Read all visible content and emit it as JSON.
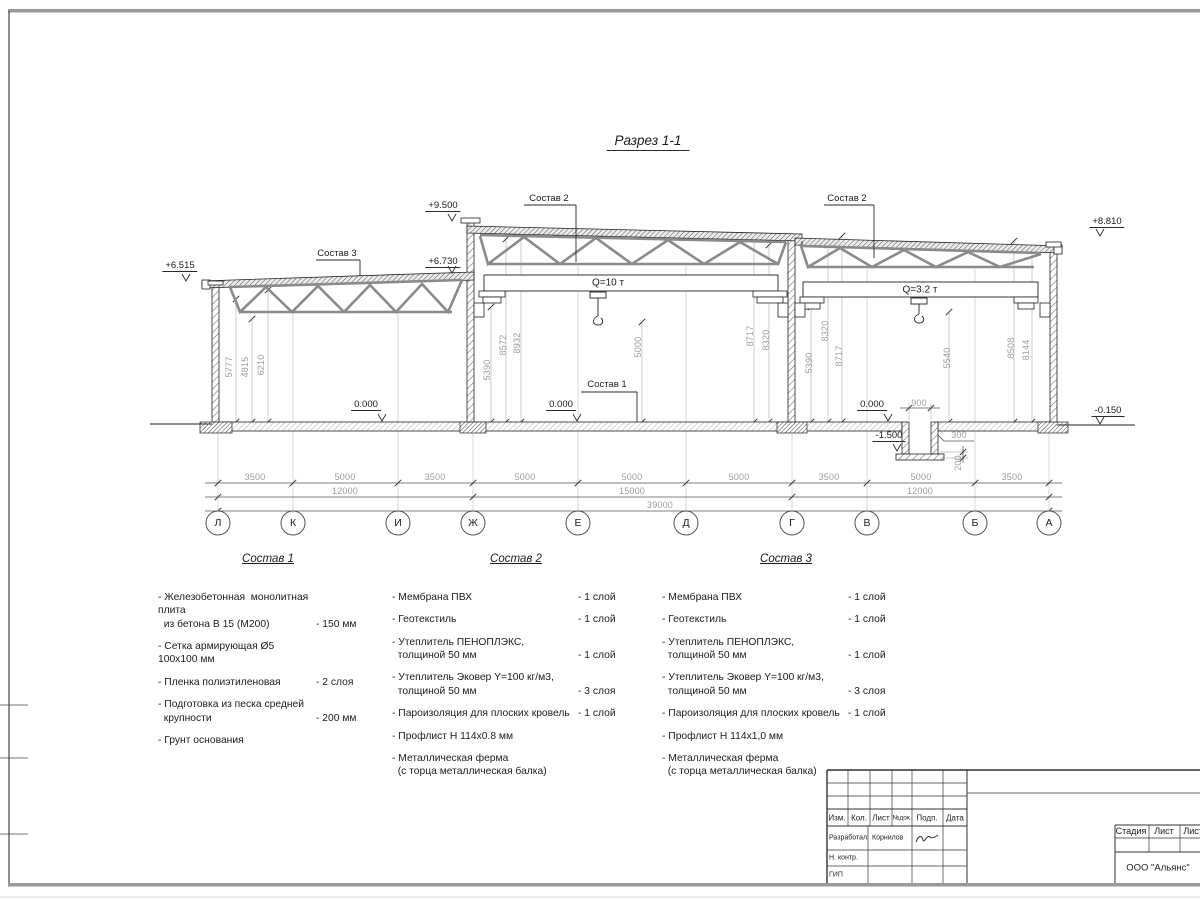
{
  "title": "Разрез 1-1",
  "section": {
    "elevations": {
      "left_eave": "+6.515",
      "low_roof_right": "+6.730",
      "high_roof": "+9.500",
      "right_roof": "+8.810",
      "ground_right": "-0.150",
      "floor_left": "0.000",
      "floor_mid": "0.000",
      "floor_right": "0.000",
      "pit_bottom": "-1.500"
    },
    "layer_refs": {
      "s1": "Состав 1",
      "s2_mid": "Состав 2",
      "s2_right": "Состав 2",
      "s3": "Состав 3"
    },
    "cranes": {
      "mid": "Q=10 т",
      "right": "Q=3.2 т"
    },
    "heights": [
      "5777",
      "4815",
      "6210",
      "5390",
      "8572",
      "8932",
      "5000",
      "8717",
      "8320",
      "5390",
      "8320",
      "8717",
      "5540",
      "8508",
      "8144"
    ],
    "pit": {
      "width": "900",
      "wall": "300",
      "slab": "200"
    },
    "dim_rows": {
      "spans": [
        "3500",
        "5000",
        "3500",
        "5000",
        "5000",
        "5000",
        "3500",
        "5000",
        "3500"
      ],
      "blocks": [
        "12000",
        "15000",
        "12000"
      ],
      "total": "39000"
    },
    "axes": [
      "Л",
      "К",
      "И",
      "Ж",
      "Е",
      "Д",
      "Г",
      "В",
      "Б",
      "А"
    ]
  },
  "compositions": [
    {
      "title": "Состав 1",
      "items": [
        {
          "name": "- Железобетонная  монолитная плита\n  из бетона В 15 (М200)",
          "value": "- 150 мм"
        },
        {
          "name": "- Сетка армирующая Ø5 100х100 мм"
        },
        {
          "name": "- Пленка полиэтиленовая",
          "value": "-  2 слоя"
        },
        {
          "name": "- Подготовка из песка средней\n  крупности",
          "value": "- 200 мм"
        },
        {
          "name": "- Грунт основания"
        }
      ]
    },
    {
      "title": "Состав 2",
      "items": [
        {
          "name": "- Мембрана ПВХ",
          "value": "- 1 слой"
        },
        {
          "name": "- Геотекстиль",
          "value": "- 1 слой"
        },
        {
          "name": "- Утеплитель ПЕНОПЛЭКС,\n  толщиной 50 мм",
          "value": "- 1 слой"
        },
        {
          "name": "- Утеплитель Эковер Y=100 кг/м3,\n  толщиной 50 мм",
          "value": "- 3 слоя"
        },
        {
          "name": "- Пароизоляция для плоских кровель",
          "value": "- 1 слой"
        },
        {
          "name": "- Профлист Н 114х0.8 мм"
        },
        {
          "name": "- Металлическая ферма\n  (с торца металлическая балка)"
        }
      ]
    },
    {
      "title": "Состав 3",
      "items": [
        {
          "name": "- Мембрана ПВХ",
          "value": "- 1 слой"
        },
        {
          "name": "- Геотекстиль",
          "value": "- 1 слой"
        },
        {
          "name": "- Утеплитель ПЕНОПЛЭКС,\n  толщиной 50 мм",
          "value": "- 1 слой"
        },
        {
          "name": "- Утеплитель Эковер Y=100 кг/м3,\n  толщиной 50 мм",
          "value": "- 3 слоя"
        },
        {
          "name": "- Пароизоляция для плоских кровель",
          "value": "- 1 слой"
        },
        {
          "name": "- Профлист Н 114х1,0 мм"
        },
        {
          "name": "- Металлическая ферма\n  (с торца металлическая балка)"
        }
      ]
    }
  ],
  "stamp": {
    "header_cols": [
      "Изм.",
      "Кол.",
      "Лист",
      "№док.",
      "Подп.",
      "Дата"
    ],
    "rows": [
      {
        "role": "Разработал",
        "name": "Корнилов"
      },
      {
        "role": "Н. контр.",
        "name": ""
      },
      {
        "role": "ГИП",
        "name": ""
      }
    ],
    "right_header": [
      "Стадия",
      "Лист",
      "Листов"
    ],
    "company": "ООО \"Альянс\""
  }
}
